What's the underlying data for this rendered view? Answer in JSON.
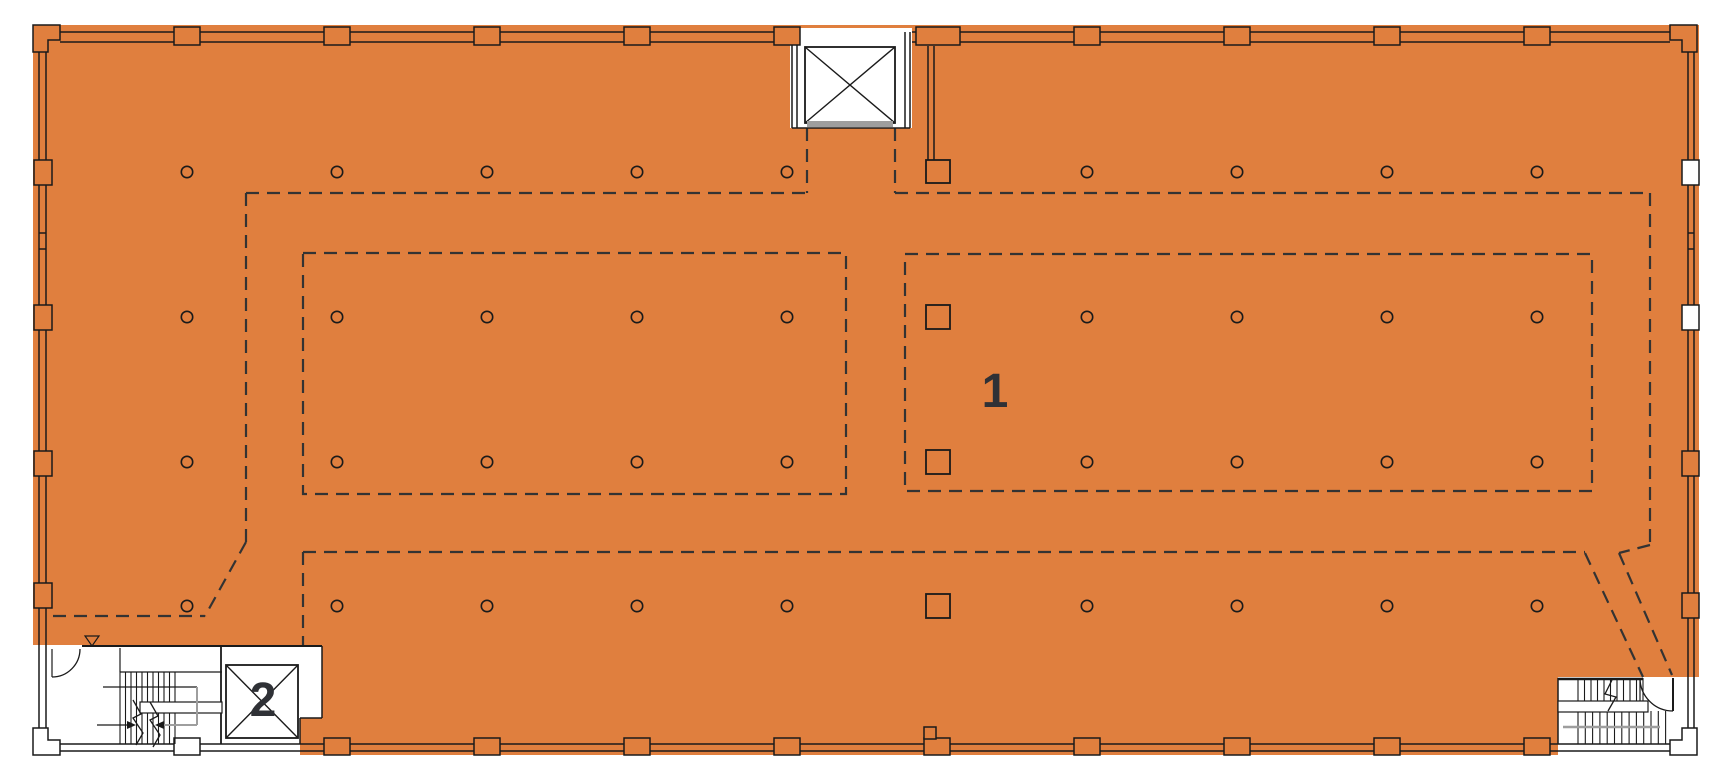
{
  "palette": {
    "highlight": "#E07F3E",
    "ink": "#1A1A1A",
    "dash": "#333333",
    "gray": "#9E9E9E",
    "white": "#FFFFFF",
    "label": "#2F3136"
  },
  "labels": {
    "zone1": "1",
    "zone2": "2"
  },
  "label_layout": [
    {
      "bind": "zone1",
      "x": 995,
      "y": 407,
      "size": 48
    },
    {
      "bind": "zone2",
      "x": 263,
      "y": 716,
      "size": 48
    }
  ],
  "canvas": {
    "w": 1714,
    "h": 780
  },
  "plan": {
    "building": {
      "x": 33,
      "y": 25,
      "w": 1666,
      "h": 730
    },
    "white_regions": [
      {
        "x": 790,
        "y": 28,
        "w": 122,
        "h": 100,
        "name": "elevator-plot"
      },
      {
        "x": 33,
        "y": 645,
        "w": 289,
        "h": 110,
        "name": "core-bottom-left"
      },
      {
        "x": 1558,
        "y": 677,
        "w": 141,
        "h": 78,
        "name": "core-bottom-right"
      }
    ],
    "highlight_patches": [
      {
        "x": 300,
        "y": 718,
        "w": 34,
        "h": 37
      }
    ],
    "corner_pilasters": [
      {
        "d": "M33,25 H60 V40 H48 V52 H33 Z",
        "fill": "highlight"
      },
      {
        "d": "M1670,25 H1697 V52 H1682 V40 H1670 Z",
        "fill": "highlight"
      },
      {
        "d": "M33,755 V728 H48 V740 H60 V755 Z",
        "fill": "white"
      },
      {
        "d": "M1697,755 V728 H1682 V740 H1670 V755 Z",
        "fill": "white"
      }
    ],
    "wall_lines": [
      [
        60,
        32,
        790,
        32
      ],
      [
        912,
        32,
        1670,
        32
      ],
      [
        60,
        42,
        790,
        42
      ],
      [
        912,
        42,
        1670,
        42
      ],
      [
        39,
        52,
        39,
        728
      ],
      [
        46,
        52,
        46,
        728
      ],
      [
        1688,
        52,
        1688,
        728
      ],
      [
        1694,
        52,
        1694,
        728
      ],
      [
        60,
        744,
        1670,
        744
      ],
      [
        60,
        751,
        1670,
        751
      ],
      [
        39,
        233,
        46,
        233
      ],
      [
        39,
        249,
        46,
        249
      ],
      [
        1688,
        233,
        1694,
        233
      ],
      [
        1688,
        249,
        1694,
        249
      ],
      [
        82,
        646,
        322,
        646,
        2
      ],
      [
        221,
        646,
        221,
        744,
        1.8
      ],
      [
        322,
        646,
        322,
        718
      ],
      [
        300,
        718,
        322,
        718
      ],
      [
        300,
        718,
        300,
        744
      ],
      [
        52,
        649,
        52,
        677,
        1.2
      ],
      [
        1558,
        679,
        1643,
        679,
        2.4
      ],
      [
        1558,
        678,
        1558,
        744
      ],
      [
        1673,
        678,
        1673,
        711,
        2
      ],
      [
        1640,
        678,
        1640,
        711,
        1.2
      ],
      [
        792,
        32,
        792,
        128
      ],
      [
        797,
        32,
        797,
        128
      ],
      [
        905,
        32,
        905,
        128
      ],
      [
        910,
        32,
        910,
        128
      ],
      [
        792,
        128,
        910,
        128
      ],
      [
        928,
        46,
        928,
        160
      ],
      [
        934,
        46,
        934,
        160
      ],
      [
        120,
        648,
        120,
        672,
        1.2
      ],
      [
        120,
        672,
        222,
        672,
        1.2
      ],
      [
        103,
        687,
        197,
        687,
        1.2
      ],
      [
        97,
        725,
        127,
        725,
        1.2
      ]
    ],
    "gray_lines": [
      [
        197,
        687,
        197,
        725,
        2
      ],
      [
        162,
        725,
        197,
        725,
        2
      ],
      [
        1563,
        727,
        1660,
        727,
        2.5
      ]
    ],
    "dashed_lines": [
      [
        246,
        193,
        807,
        193
      ],
      [
        895,
        193,
        1650,
        193
      ],
      [
        807,
        128,
        807,
        193
      ],
      [
        895,
        128,
        895,
        193
      ],
      [
        246,
        193,
        246,
        542
      ],
      [
        246,
        542,
        205,
        616
      ],
      [
        53,
        616,
        205,
        616
      ],
      [
        303,
        552,
        1585,
        552
      ],
      [
        303,
        552,
        303,
        645
      ],
      [
        1650,
        193,
        1650,
        545
      ],
      [
        1650,
        545,
        1619,
        553
      ],
      [
        1585,
        553,
        1643,
        677
      ],
      [
        1619,
        553,
        1672,
        675
      ]
    ],
    "dashed_rects": [
      {
        "x": 303,
        "y": 253,
        "w": 543,
        "h": 241
      },
      {
        "x": 905,
        "y": 254,
        "w": 687,
        "h": 237
      }
    ],
    "pilasters": [
      {
        "x": 174,
        "y": 27,
        "w": 26,
        "h": 18
      },
      {
        "x": 324,
        "y": 27,
        "w": 26,
        "h": 18
      },
      {
        "x": 474,
        "y": 27,
        "w": 26,
        "h": 18
      },
      {
        "x": 624,
        "y": 27,
        "w": 26,
        "h": 18
      },
      {
        "x": 774,
        "y": 27,
        "w": 26,
        "h": 18
      },
      {
        "x": 916,
        "y": 27,
        "w": 44,
        "h": 18
      },
      {
        "x": 1074,
        "y": 27,
        "w": 26,
        "h": 18
      },
      {
        "x": 1224,
        "y": 27,
        "w": 26,
        "h": 18
      },
      {
        "x": 1374,
        "y": 27,
        "w": 26,
        "h": 18
      },
      {
        "x": 1524,
        "y": 27,
        "w": 26,
        "h": 18
      },
      {
        "x": 174,
        "y": 738,
        "w": 26,
        "h": 17,
        "fill": "white"
      },
      {
        "x": 324,
        "y": 738,
        "w": 26,
        "h": 17
      },
      {
        "x": 474,
        "y": 738,
        "w": 26,
        "h": 17
      },
      {
        "x": 624,
        "y": 738,
        "w": 26,
        "h": 17
      },
      {
        "x": 774,
        "y": 738,
        "w": 26,
        "h": 17
      },
      {
        "x": 924,
        "y": 738,
        "w": 26,
        "h": 17
      },
      {
        "x": 1074,
        "y": 738,
        "w": 26,
        "h": 17
      },
      {
        "x": 1224,
        "y": 738,
        "w": 26,
        "h": 17
      },
      {
        "x": 1374,
        "y": 738,
        "w": 26,
        "h": 17
      },
      {
        "x": 1524,
        "y": 738,
        "w": 26,
        "h": 17
      },
      {
        "x": 924,
        "y": 727,
        "w": 12,
        "h": 12
      },
      {
        "x": 34,
        "y": 160,
        "w": 18,
        "h": 25
      },
      {
        "x": 34,
        "y": 305,
        "w": 18,
        "h": 25
      },
      {
        "x": 34,
        "y": 451,
        "w": 18,
        "h": 25
      },
      {
        "x": 34,
        "y": 583,
        "w": 18,
        "h": 25
      },
      {
        "x": 1682,
        "y": 160,
        "w": 17,
        "h": 25,
        "fill": "white"
      },
      {
        "x": 1682,
        "y": 305,
        "w": 17,
        "h": 25,
        "fill": "white"
      },
      {
        "x": 1682,
        "y": 451,
        "w": 17,
        "h": 25
      },
      {
        "x": 1682,
        "y": 593,
        "w": 17,
        "h": 25
      }
    ],
    "shafts": [
      {
        "x": 805,
        "y": 47,
        "w": 90,
        "h": 76,
        "name": "elevator-shaft"
      },
      {
        "x": 226,
        "y": 665,
        "w": 72,
        "h": 73,
        "name": "shaft-2"
      }
    ],
    "shaft_x_lines": [
      [
        805,
        47,
        895,
        123
      ],
      [
        895,
        47,
        805,
        123
      ],
      [
        226,
        665,
        298,
        738
      ],
      [
        298,
        665,
        226,
        738
      ]
    ],
    "sill": {
      "x": 807,
      "y": 121,
      "w": 86,
      "h": 6
    },
    "column_circles": {
      "rows": [
        172,
        317,
        462,
        606
      ],
      "cols": [
        187,
        337,
        487,
        637,
        787,
        1087,
        1237,
        1387,
        1537
      ],
      "r": 5.7
    },
    "column_squares": [
      {
        "x": 926,
        "y": 160,
        "w": 24,
        "h": 23
      },
      {
        "x": 926,
        "y": 305,
        "w": 24,
        "h": 24
      },
      {
        "x": 926,
        "y": 450,
        "w": 24,
        "h": 24
      },
      {
        "x": 926,
        "y": 594,
        "w": 24,
        "h": 24
      }
    ],
    "tread_groups": [
      {
        "x0": 120,
        "dx": 5.5,
        "n": 11,
        "y1": 672,
        "y2": 744
      },
      {
        "x0": 1578,
        "dx": 6.5,
        "n": 11,
        "y1": 678,
        "y2": 711
      },
      {
        "x0": 1578,
        "dx": 7.3,
        "n": 13,
        "y1": 711,
        "y2": 744
      }
    ],
    "landing_bands": [
      {
        "x": 140,
        "y": 702,
        "w": 82,
        "h": 11
      },
      {
        "x": 1558,
        "y": 701,
        "w": 90,
        "h": 11
      }
    ],
    "paths": [
      {
        "d": "M80,649 A28,28 0 0 1 52,677",
        "sw": 1.3,
        "name": "door-arc-bl"
      },
      {
        "d": "M1640,678 A33,33 0 0 0 1673,711",
        "sw": 1.3,
        "name": "door-arc-br"
      },
      {
        "d": "M133,700 L141,714 L133,718 L143,733 L136,745",
        "sw": 1.3,
        "name": "stair-break-line"
      },
      {
        "d": "M150,702 L158,716 L150,720 L160,735 L153,747",
        "sw": 1.3,
        "name": "stair-break-line"
      },
      {
        "d": "M1612,680 L1605,694 L1616,697 L1608,711",
        "sw": 1.3,
        "name": "stair-break-line"
      },
      {
        "d": "M85,636 H99 L92,646 Z",
        "sw": 1.2,
        "name": "datum-triangle-icon"
      },
      {
        "d": "M127,721 L136,725 L127,729 Z",
        "fill": "ink",
        "sw": 0,
        "name": "stair-arrow-icon"
      },
      {
        "d": "M164,721 L155,725 L164,729 Z",
        "fill": "ink",
        "sw": 0,
        "name": "stair-arrow-icon"
      }
    ]
  }
}
